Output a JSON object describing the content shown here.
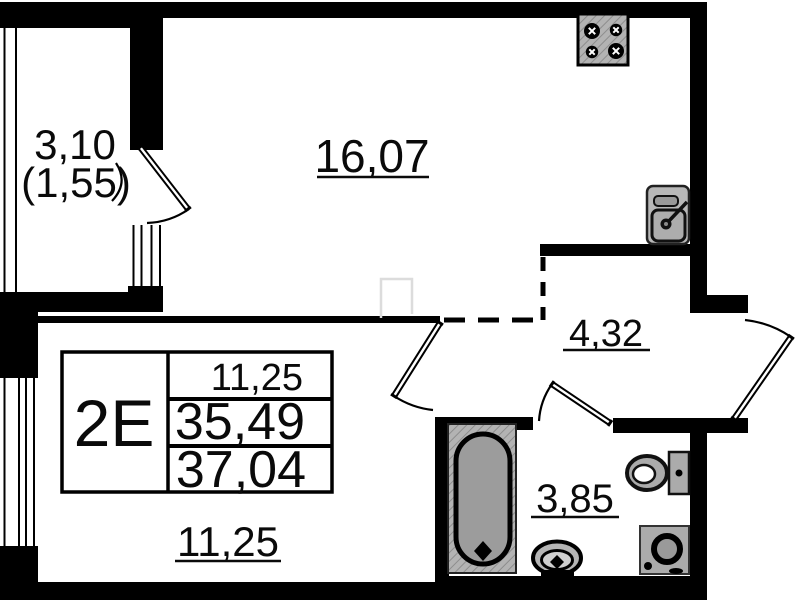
{
  "floorplan": {
    "unit": {
      "type": "2Е",
      "living_area": "11,25",
      "area_without_balcony": "35,49",
      "total_area": "37,04"
    },
    "rooms": {
      "balcony": {
        "area": "3,10",
        "area_reduced": "(1,55)"
      },
      "living_room": {
        "area": "16,07"
      },
      "hallway": {
        "area": "4,32"
      },
      "bathroom": {
        "area": "3,85"
      },
      "bedroom": {
        "area": "11,25"
      }
    },
    "fixtures": [
      "stove",
      "kitchen-sink",
      "bathtub",
      "wash-basin",
      "toilet",
      "washing-machine"
    ],
    "colors": {
      "walls": "#000000",
      "background": "#ffffff",
      "fixture_fill": "#ababab",
      "watermark": "#dcdcdc"
    }
  }
}
